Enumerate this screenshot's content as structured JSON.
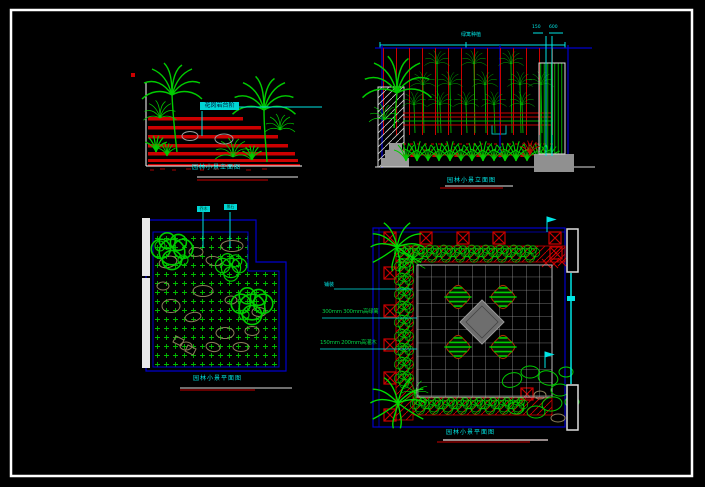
{
  "canvas": {
    "width": 705,
    "height": 487,
    "background": "#000000",
    "frame_color": "#ffffff"
  },
  "palette": {
    "line_red": "#cc0000",
    "plant_green": "#00cc00",
    "annotation_cyan": "#00e5e5",
    "border_blue": "#0000cc",
    "rock_tan": "#8b7e5a",
    "paving_gray": "#999999",
    "wall_white": "#e8e8e8"
  },
  "panels": {
    "elevation_left": {
      "caption": "园林小景立面图",
      "material_label": "花岗岩台阶"
    },
    "elevation_right": {
      "caption": "园林小景立面图",
      "planting_label": "绿篱种植",
      "dim_label_left": "150",
      "dim_label_right": "600"
    },
    "plan_left": {
      "caption": "园林小景平面图",
      "flag_label_1": "乔木",
      "flag_label_2": "景石"
    },
    "plan_right": {
      "caption": "园林小景平面图",
      "hedge_annotation_1": "300mm 300mm高绿篱",
      "hedge_annotation_2": "150mm 200mm高灌木",
      "paving_annotation": "铺装"
    }
  }
}
